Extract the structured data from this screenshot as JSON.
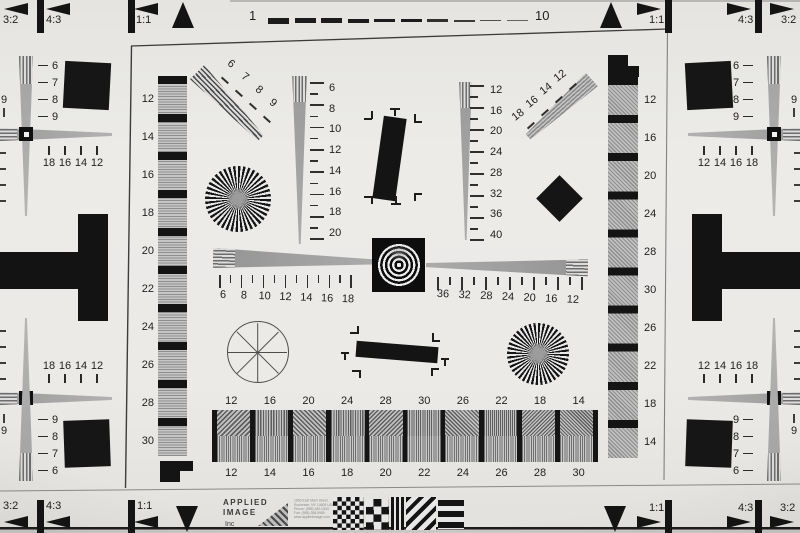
{
  "colors": {
    "paper": "#ecebe8",
    "ink": "#141414",
    "gray_wedge": "#9c9c9c",
    "label": "#1f1f1f"
  },
  "aspect_markers": {
    "top_left": [
      "3:2",
      "4:3",
      "1:1"
    ],
    "top_right": [
      "1:1",
      "4:3",
      "3:2"
    ],
    "bottom_left": [
      "3:2",
      "4:3",
      "1:1"
    ],
    "bottom_right": [
      "1:1",
      "4:3",
      "3:2"
    ]
  },
  "top_scale": {
    "start": "1",
    "end": "10"
  },
  "strips": {
    "left_labels": [
      "12",
      "14",
      "16",
      "18",
      "20",
      "22",
      "24",
      "26",
      "28",
      "30"
    ],
    "right_labels": [
      "12",
      "16",
      "20",
      "24",
      "28",
      "30",
      "26",
      "22",
      "18",
      "14"
    ]
  },
  "wedge_scales": {
    "inner_left_vertical": [
      "6",
      "8",
      "10",
      "12",
      "14",
      "16",
      "18",
      "20"
    ],
    "inner_center_vertical": [
      "12",
      "16",
      "20",
      "24",
      "28",
      "32",
      "36",
      "40"
    ],
    "diagonal_top_left": [
      "6",
      "7",
      "8",
      "9"
    ],
    "diagonal_top_right": [
      "12",
      "14",
      "16",
      "18"
    ],
    "horizontal_left": [
      "6",
      "8",
      "10",
      "12",
      "14",
      "16",
      "18"
    ],
    "horizontal_right": [
      "36",
      "32",
      "28",
      "24",
      "20",
      "16",
      "12"
    ]
  },
  "corner_clusters": {
    "top_left": {
      "dash_labels": [
        "6",
        "7",
        "8",
        "9"
      ],
      "tick_labels": [
        "18",
        "16",
        "14",
        "12"
      ],
      "edge_label": "9"
    },
    "bottom_left": {
      "tick_labels": [
        "18",
        "16",
        "14",
        "12"
      ],
      "dash_labels": [
        "9",
        "8",
        "7",
        "6"
      ],
      "edge_label": "9"
    },
    "top_right": {
      "dash_labels": [
        "6",
        "7",
        "8",
        "9"
      ],
      "tick_labels": [
        "12",
        "14",
        "16",
        "18"
      ],
      "edge_label": "9"
    },
    "bottom_right": {
      "tick_labels": [
        "12",
        "14",
        "16",
        "18"
      ],
      "dash_labels": [
        "9",
        "8",
        "7",
        "6"
      ],
      "edge_label": "9"
    }
  },
  "bottom_chart": {
    "top_labels": [
      "12",
      "16",
      "20",
      "24",
      "28",
      "30",
      "26",
      "22",
      "18",
      "14"
    ],
    "bottom_labels": [
      "12",
      "14",
      "16",
      "18",
      "20",
      "22",
      "24",
      "26",
      "28",
      "30"
    ]
  },
  "logo": {
    "name_line1": "APPLIED",
    "name_line2": "IMAGE",
    "name_line3": "Inc",
    "address_lines": [
      "1653 East Main Street",
      "Rochester, NY 14609 USA",
      "Phone: (585) 482-0300",
      "Fax: (585) 288-5989",
      "www.appliedimage.com"
    ]
  }
}
